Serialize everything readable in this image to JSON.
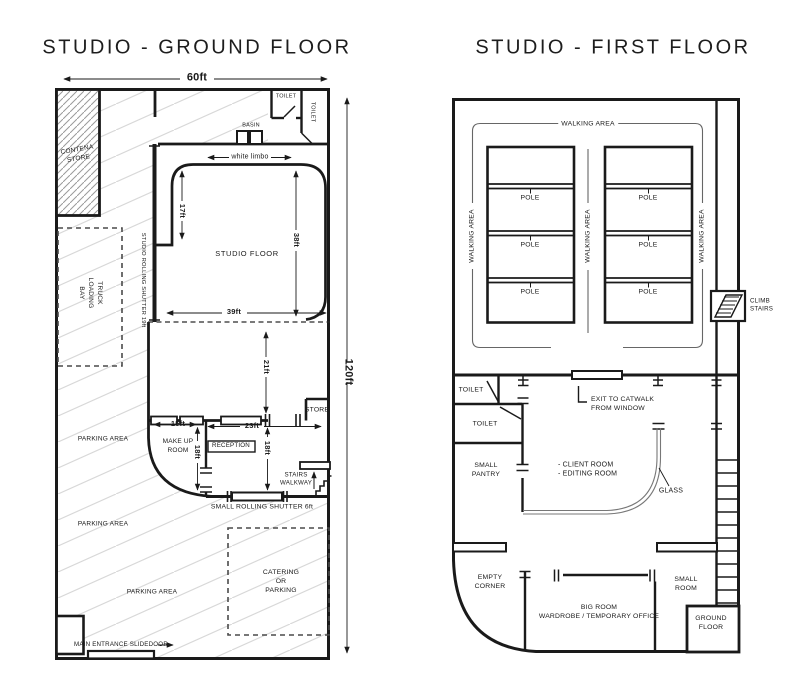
{
  "colors": {
    "line": "#1a1a1a",
    "hatch_light": "#d8d8d8",
    "hatch_dense": "#9a9a9a",
    "bracket_gray": "#666666",
    "glass_gray": "#777777"
  },
  "ground_floor": {
    "title": "STUDIO - GROUND FLOOR",
    "dims": {
      "width": "60ft",
      "height": "120ft",
      "white_limbo": "white limbo",
      "d17": "17ft",
      "d38": "38ft",
      "d39": "39ft",
      "d21": "21ft",
      "d15": "15ft",
      "d23": "23ft",
      "d18_left": "18ft",
      "d18_right": "18ft"
    },
    "rooms": {
      "contena_store": "CONTENA\nSTORE",
      "truck_loading_bay": "TRUCK\nLOADING\nBAY",
      "studio_rolling_shutter": "STUDIO ROLLING SHUTTER 19ft",
      "toilet_top": "TOILET",
      "toilet_side": "TOILET",
      "basin": "BASIN",
      "studio_floor": "STUDIO FLOOR",
      "make_up_room": "MAKE UP\nROOM",
      "reception": "RECEPTION",
      "store": "STORE",
      "stairs_walkway": "STAIRS\nWALKWAY",
      "small_rolling_shutter": "SMALL ROLLING SHUTTER 6ft",
      "parking_1": "PARKING AREA",
      "parking_2": "PARKING AREA",
      "parking_3": "PARKING AREA",
      "catering": "CATERING\nOR\nPARKING",
      "main_entrance": "MAIN ENTRANCE SLIDEDOOR"
    }
  },
  "first_floor": {
    "title": "STUDIO - FIRST FLOOR",
    "walking_area_top": "WALKING AREA",
    "walking_area_left": "WALKING AREA",
    "walking_area_center": "WALKING AREA",
    "walking_area_right": "WALKING AREA",
    "poles": [
      "POLE",
      "POLE",
      "POLE",
      "POLE",
      "POLE",
      "POLE"
    ],
    "rooms": {
      "climb_stairs": "CLIMB\nSTAIRS",
      "toilet_1": "TOILET",
      "toilet_2": "TOILET",
      "small_pantry": "SMALL\nPANTRY",
      "exit_catwalk": "EXIT TO CATWALK\nFROM WINDOW",
      "client_editing": "- CLIENT ROOM\n- EDITING ROOM",
      "glass": "GLASS",
      "empty_corner": "EMPTY\nCORNER",
      "big_room": "BIG ROOM\nWARDROBE / TEMPORARY OFFICE",
      "small_room": "SMALL\nROOM",
      "ground_floor_stairs": "GROUND\nFLOOR"
    }
  }
}
